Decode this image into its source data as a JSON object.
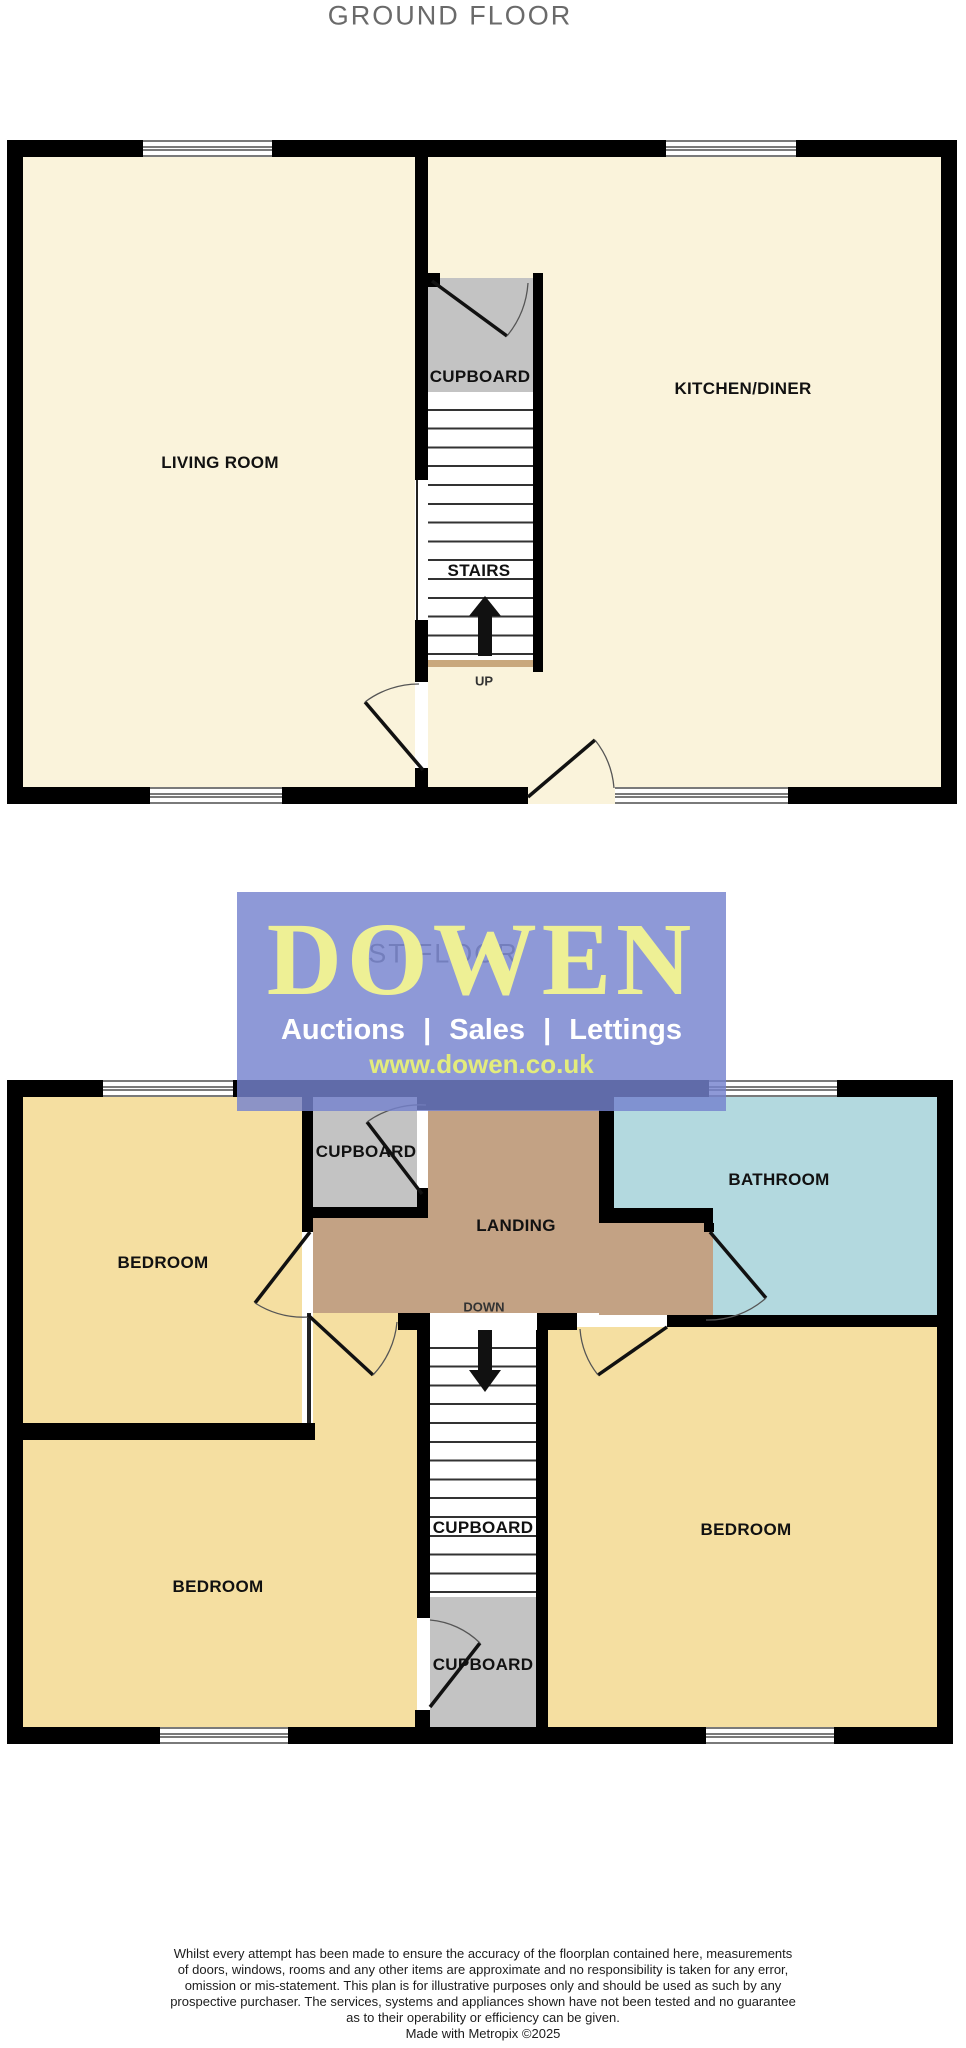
{
  "ground_floor": {
    "title": "GROUND FLOOR",
    "rooms": {
      "living_room": "LIVING ROOM",
      "kitchen_diner": "KITCHEN/DINER",
      "cupboard": "CUPBOARD",
      "stairs": "STAIRS"
    },
    "stairs_direction": "UP"
  },
  "first_floor": {
    "title": "1ST FLOOR",
    "rooms": {
      "bedroom_top_left": "BEDROOM",
      "bedroom_bottom_left": "BEDROOM",
      "bedroom_right": "BEDROOM",
      "bathroom": "BATHROOM",
      "landing": "LANDING",
      "cupboard_top": "CUPBOARD",
      "cupboard_stairs": "CUPBOARD",
      "cupboard_bottom": "CUPBOARD"
    },
    "stairs_direction": "DOWN"
  },
  "logo": {
    "brand": "DOWEN",
    "tagline": "Auctions | Sales | Lettings",
    "website": "www.dowen.co.uk"
  },
  "footer": {
    "disclaimer_lines": [
      "Whilst every attempt has been made to ensure the accuracy of the floorplan contained here, measurements",
      "of doors, windows, rooms and any other items are approximate and no responsibility is taken for any error,",
      "omission or mis-statement. This plan is for illustrative purposes only and should be used as such by any",
      "prospective purchaser. The services, systems and appliances shown have not been tested and no guarantee",
      "as to their operability or efficiency can be given."
    ],
    "credit": "Made with Metropix ©2025"
  },
  "colors": {
    "wall": "#000000",
    "room-cream": "#FAF3DB",
    "room-yellow": "#F5DFA1",
    "room-tan": "#C3A284",
    "room-blue": "#B3D9DF",
    "room-gray": "#C3C3C3",
    "stair-strip": "#C9A87D",
    "logo-purple": "#7583CE",
    "logo-yellow": "#EEF095",
    "logo-web-yellow": "#E3EC7C",
    "title-gray": "#6A6A6A",
    "label-black": "#111111"
  }
}
